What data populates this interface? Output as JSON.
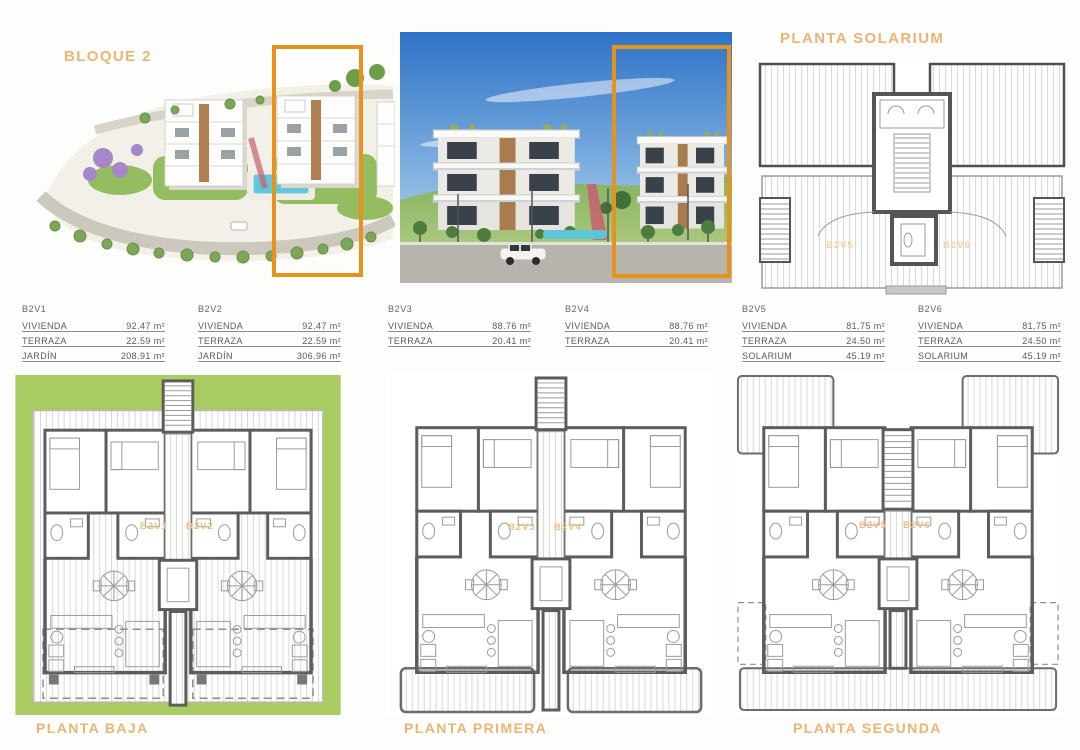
{
  "titles": {
    "bloque": "BLOQUE 2",
    "solarium": "PLANTA SOLARIUM",
    "plan_baja": "PLANTA BAJA",
    "plan_primera": "PLANTA PRIMERA",
    "plan_segunda": "PLANTA SEGUNDA"
  },
  "unit_tables": [
    {
      "unit": "B2V1",
      "rows": [
        {
          "label": "VIVIENDA",
          "value": "92.47 m²"
        },
        {
          "label": "TERRAZA",
          "value": "22.59 m²"
        },
        {
          "label": "JARDÍN",
          "value": "208.91 m²"
        }
      ]
    },
    {
      "unit": "B2V2",
      "rows": [
        {
          "label": "VIVIENDA",
          "value": "92.47 m²"
        },
        {
          "label": "TERRAZA",
          "value": "22.59 m²"
        },
        {
          "label": "JARDÍN",
          "value": "306.96 m²"
        }
      ]
    },
    {
      "unit": "B2V3",
      "rows": [
        {
          "label": "VIVIENDA",
          "value": "88.76 m²"
        },
        {
          "label": "TERRAZA",
          "value": "20.41 m²"
        }
      ]
    },
    {
      "unit": "B2V4",
      "rows": [
        {
          "label": "VIVIENDA",
          "value": "88.76 m²"
        },
        {
          "label": "TERRAZA",
          "value": "20.41 m²"
        }
      ]
    },
    {
      "unit": "B2V5",
      "rows": [
        {
          "label": "VIVIENDA",
          "value": "81.75 m²"
        },
        {
          "label": "TERRAZA",
          "value": "24.50 m²"
        },
        {
          "label": "SOLARIUM",
          "value": "45.19 m²"
        }
      ]
    },
    {
      "unit": "B2V6",
      "rows": [
        {
          "label": "VIVIENDA",
          "value": "81.75 m²"
        },
        {
          "label": "TERRAZA",
          "value": "24.50 m²"
        },
        {
          "label": "SOLARIUM",
          "value": "45.19 m²"
        }
      ]
    }
  ],
  "floor_plan_labels": {
    "baja_left": "B2V1",
    "baja_right": "B2V2",
    "primera_left": "B2V3",
    "primera_right": "B2V4",
    "segunda_left": "B2V5",
    "segunda_right": "B2V6",
    "solarium_left": "B2V5",
    "solarium_right": "B2V6"
  },
  "colors": {
    "accent_orange": "#e8921e",
    "title_tan": "#eab476",
    "garden_green": "#a9cc62",
    "wall_gray": "#5c5c5c",
    "pool_blue": "#62c7d8"
  }
}
